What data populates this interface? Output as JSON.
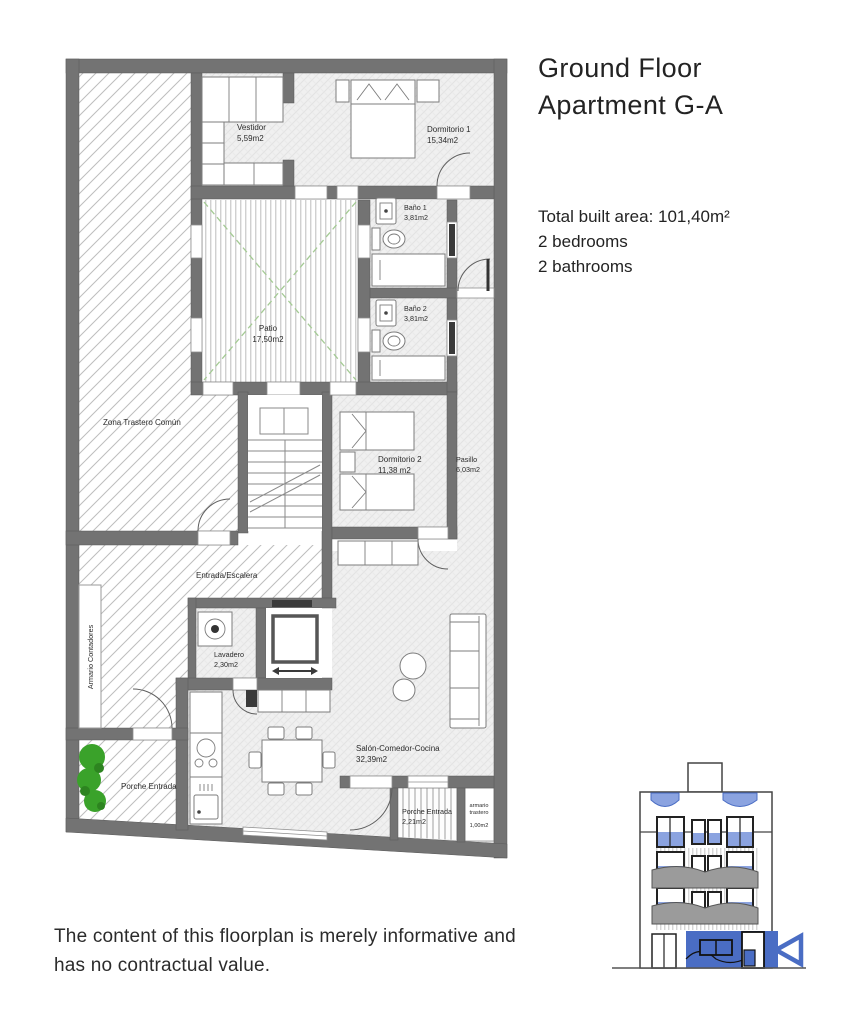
{
  "header": {
    "title_line1": "Ground Floor",
    "title_line2": "Apartment G-A",
    "total_built_area": "Total built area: 101,40m²",
    "bedrooms": "2 bedrooms",
    "bathrooms": "2 bathrooms"
  },
  "rooms": {
    "zona_trastero": {
      "name": "Zona Trastero Común"
    },
    "vestidor": {
      "name": "Vestidor",
      "area": "5,59m2"
    },
    "dormitorio1": {
      "name": "Dormitorio 1",
      "area": "15,34m2"
    },
    "bano1": {
      "name": "Baño 1",
      "area": "3,81m2"
    },
    "bano2": {
      "name": "Baño 2",
      "area": "3,81m2"
    },
    "patio": {
      "name": "Patio",
      "area": "17,50m2"
    },
    "dormitorio2": {
      "name": "Dormitorio 2",
      "area": "11,38 m2"
    },
    "pasillo": {
      "name": "Pasillo",
      "area": "6,03m2"
    },
    "entrada": {
      "name": "Entrada/Escalera"
    },
    "armario_contadores": {
      "name": "Armario Contadores"
    },
    "lavadero": {
      "name": "Lavadero",
      "area": "2,30m2"
    },
    "porche_oeste": {
      "name": "Porche Entrada"
    },
    "salon": {
      "name": "Salón-Comedor-Cocina",
      "area": "32,39m2"
    },
    "porche_sur": {
      "name": "Porche Entrada",
      "area": "2,21m2"
    },
    "armario_trastero": {
      "name_line1": "armario",
      "name_line2": "trastero",
      "area": "1,00m2"
    }
  },
  "footer": {
    "disclaimer_line1": "The content of this floorplan is merely informative and",
    "disclaimer_line2": "has no contractual value."
  },
  "colors": {
    "wall_gray": "#737373",
    "accent_blue": "#4a6dc4",
    "light_blue": "#8ba3e0",
    "plant_green": "#3aa22a",
    "patio_cross_green": "#a4ca94"
  }
}
